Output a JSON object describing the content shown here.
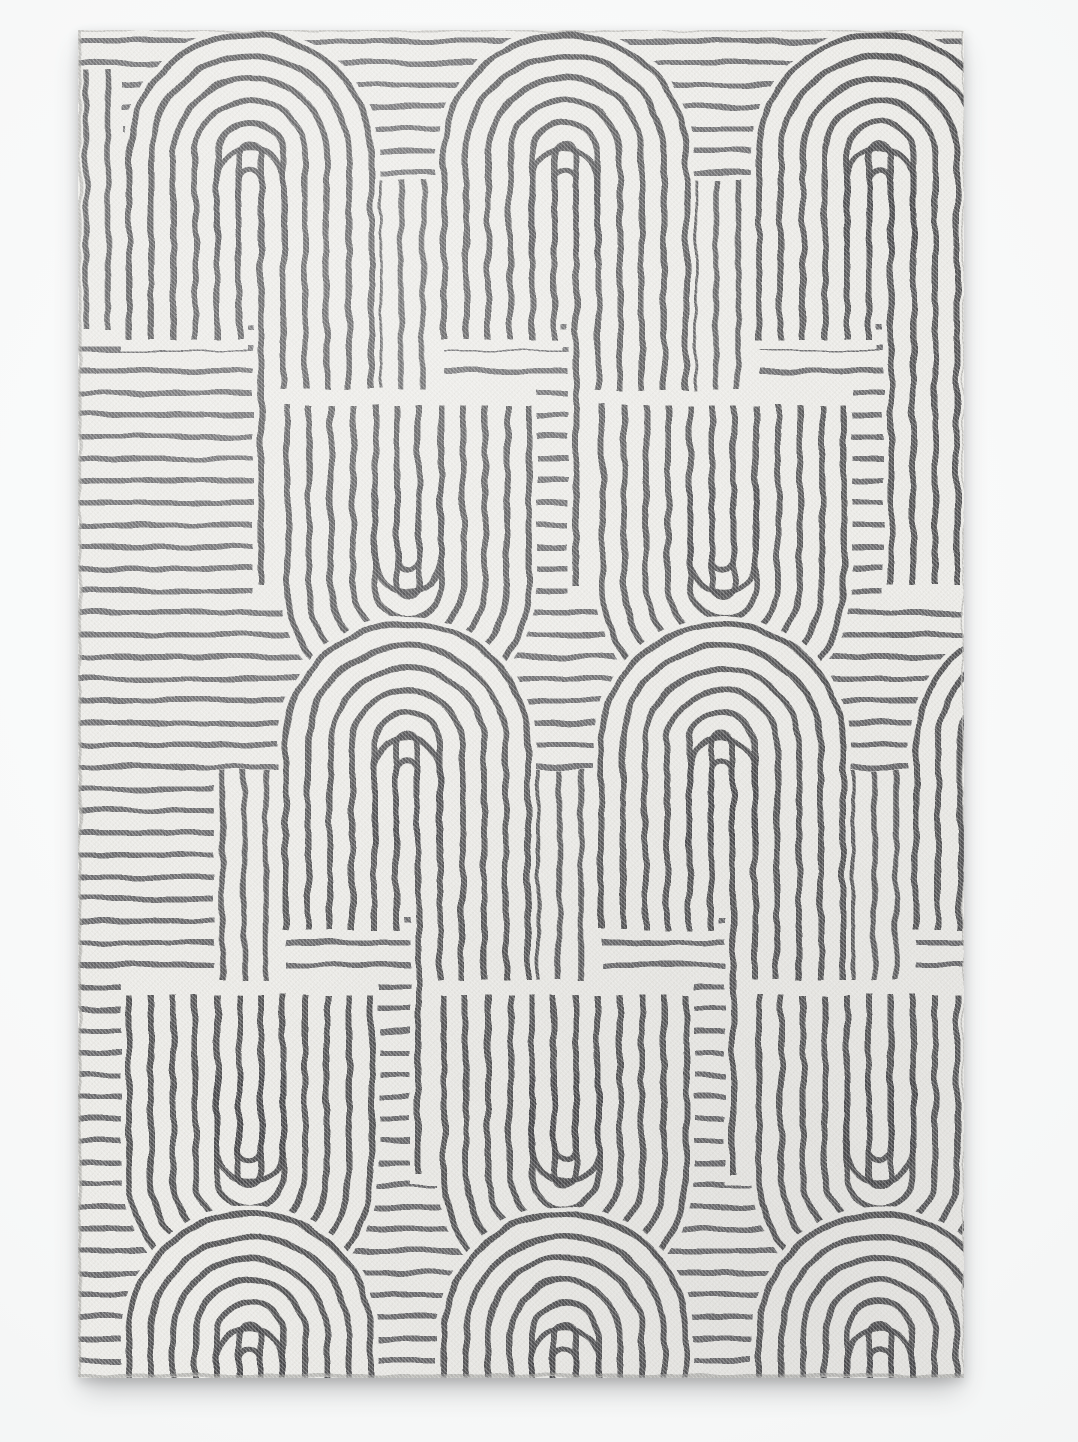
{
  "image": {
    "alt": "Top-down studio product photo of a rectangular black-and-white flat-woven area rug with a mid-century geometric pattern of concentric arches, U-turns, hooks and stripes on an ivory ground, casting a soft shadow on a pale background",
    "scene": "studio product photograph",
    "background_color": "#f4f5f5"
  },
  "rug": {
    "shape": "rectangle",
    "orientation": "portrait",
    "ground_color": "#f1f0ec",
    "pattern_color": "#3b3b3e",
    "edge_seam_color": "#9a9a96",
    "pattern_style": "Art Deco / mid-century concentric arch maze",
    "texture": "flat-woven twill grain",
    "stripe_pitch_px": 22,
    "lines_per_comb": 6,
    "motif_counts": {
      "down_arches": 9,
      "up_turns": 4,
      "inner_hooks": 13,
      "vertical_stripe_blocks": 6
    }
  }
}
